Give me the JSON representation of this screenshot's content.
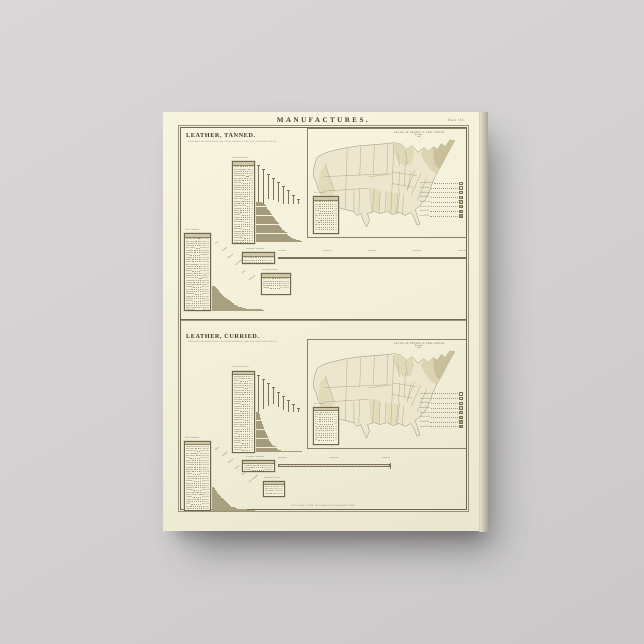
{
  "artwork": {
    "title": "MANUFACTURES.",
    "plate_number": "Plate 153.",
    "imprint": "COPYRIGHT, 1883, BY CHARLES SCRIBNER'S SONS."
  },
  "map": {
    "title": "VALUE OF PRODUCT, PER CAPITA",
    "subtitle": "By States.",
    "year": "1880.",
    "legend": [
      "Less than 10 cts.",
      "10 to 20 cts.",
      "20 to 40 cts.",
      "40 to 60 cts.",
      "60 to 80 cts.",
      "80 cts. to $1.",
      "$1 to $1.50",
      "Over $1.50"
    ],
    "legend_colors": [
      "#f1edd8",
      "#e9e4c8",
      "#ded7b6",
      "#d2caa4",
      "#c5bc92",
      "#b7ad80",
      "#a89e70",
      "#968c5e"
    ]
  },
  "sections": [
    {
      "id": "tanned",
      "heading": "LEATHER, TANNED.",
      "subheading": "SHOWING FOR EACH STATE THE TOTAL PRODUCT, AND THE VALUE PER CAPITA.",
      "per_capita": {
        "title": "Value per Capita.",
        "rows": [
          [
            "Maine",
            "$2.41"
          ],
          [
            "New Hampshire",
            "$2.10"
          ],
          [
            "Wisconsin",
            "$1.64"
          ],
          [
            "Pennsylvania",
            "$1.38"
          ],
          [
            "Massachusetts",
            "$1.21"
          ],
          [
            "New Jersey",
            "$1.05"
          ],
          [
            "Maryland",
            ".92"
          ],
          [
            "New York",
            ".88"
          ],
          [
            "Michigan",
            ".84"
          ],
          [
            "Vermont",
            ".71"
          ],
          [
            "Delaware",
            ".63"
          ],
          [
            "Virginia",
            ".54"
          ],
          [
            "California",
            ".52"
          ],
          [
            "Connecticut",
            ".47"
          ],
          [
            "West Virginia",
            ".44"
          ],
          [
            "Kentucky",
            ".41"
          ],
          [
            "Ohio",
            ".38"
          ],
          [
            "North Carolina",
            ".33"
          ],
          [
            "Tennessee",
            ".29"
          ],
          [
            "Illinois",
            ".27"
          ],
          [
            "Indiana",
            ".25"
          ],
          [
            "Missouri",
            ".22"
          ],
          [
            "Georgia",
            ".19"
          ],
          [
            "Oregon",
            ".17"
          ],
          [
            "New Mexico",
            ".15"
          ],
          [
            "Texas",
            ".12"
          ],
          [
            "Iowa",
            ".11"
          ],
          [
            "Minnesota",
            ".10"
          ],
          [
            "Alabama",
            ".08"
          ],
          [
            "Arkansas",
            ".07"
          ],
          [
            "South Carolina",
            ".06"
          ],
          [
            "Mississippi",
            ".05"
          ],
          [
            "Louisiana",
            ".04"
          ],
          [
            "Kansas",
            ".03"
          ],
          [
            "Nebraska",
            ".02"
          ],
          [
            "Florida",
            ".01"
          ]
        ]
      },
      "total_products": {
        "title": "Total Products.",
        "rows": [
          [
            "Pennsylvania",
            "$24,173,402"
          ],
          [
            "New York",
            "$22,261,522"
          ],
          [
            "Massachusetts",
            "$10,354,704"
          ],
          [
            "Wisconsin",
            "$7,967,733"
          ],
          [
            "New Jersey",
            "$5,903,292"
          ],
          [
            "Michigan",
            "$5,120,611"
          ],
          [
            "Maryland",
            "$3,986,240"
          ],
          [
            "Ohio",
            "$3,643,815"
          ],
          [
            "Virginia",
            "$2,791,406"
          ],
          [
            "Illinois",
            "$2,514,572"
          ],
          [
            "Maine",
            "$2,382,461"
          ],
          [
            "New Hampshire",
            "$2,150,224"
          ],
          [
            "California",
            "$1,983,570"
          ],
          [
            "Kentucky",
            "$1,701,333"
          ],
          [
            "Indiana",
            "$1,504,216"
          ],
          [
            "Missouri",
            "$1,218,004"
          ],
          [
            "Tennessee",
            "$1,004,152"
          ],
          [
            "North Carolina",
            "$892,317"
          ],
          [
            "Connecticut",
            "$801,454"
          ],
          [
            "Georgia",
            "$611,208"
          ],
          [
            "West Virginia",
            "$540,163"
          ],
          [
            "Vermont",
            "$471,052"
          ],
          [
            "Texas",
            "$392,618"
          ],
          [
            "Iowa",
            "$343,207"
          ],
          [
            "Minnesota",
            "$301,116"
          ],
          [
            "Oregon",
            "$252,483"
          ],
          [
            "Alabama",
            "$203,371"
          ],
          [
            "Delaware",
            "$181,226"
          ],
          [
            "Kansas",
            "$142,165"
          ],
          [
            "Arkansas",
            "$110,304"
          ],
          [
            "South Carolina",
            "$84,213"
          ],
          [
            "Mississippi",
            "$61,182"
          ],
          [
            "Louisiana",
            "$43,075"
          ],
          [
            "Nebraska",
            "$31,040"
          ],
          [
            "Rhode Island",
            "$22,516"
          ],
          [
            "Florida",
            "$11,203"
          ]
        ]
      },
      "scale_bar": {
        "title": "Principal Products.",
        "rows": [
          [
            "Sole Leather",
            "$52,240,301"
          ],
          [
            "Upper Leather",
            "$31,173,212"
          ],
          [
            "All Other",
            "$20,986,507"
          ]
        ],
        "ticks": [
          "10,000,000",
          "20,000,000",
          "30,000,000",
          "40,000,000",
          "50,000,000"
        ]
      },
      "sub_box": {
        "title": "Principal Cities.",
        "rows": [
          [
            "New York",
            "$8,214,311"
          ],
          [
            "Philadelphia",
            "$6,102,208"
          ],
          [
            "Boston",
            "$4,311,170"
          ],
          [
            "Baltimore",
            "$2,208,314"
          ],
          [
            "Chicago",
            "$1,754,220"
          ]
        ]
      },
      "corner_table": {
        "title": "Per Capita.",
        "rows": [
          [
            "Me.",
            "2.41"
          ],
          [
            "N.H.",
            "2.10"
          ],
          [
            "Wis.",
            "1.64"
          ],
          [
            "Pa.",
            "1.38"
          ],
          [
            "Mass.",
            "1.21"
          ],
          [
            "N.J.",
            "1.05"
          ],
          [
            "Md.",
            ".92"
          ],
          [
            "N.Y.",
            ".88"
          ],
          [
            "Mich.",
            ".84"
          ],
          [
            "Vt.",
            ".71"
          ],
          [
            "Del.",
            ".63"
          ],
          [
            "Va.",
            ".54"
          ],
          [
            "Cal.",
            ".52"
          ]
        ]
      }
    },
    {
      "id": "curried",
      "heading": "LEATHER, CURRIED.",
      "subheading": "SHOWING FOR EACH STATE THE TOTAL PRODUCT, AND THE VALUE PER CAPITA.",
      "per_capita": {
        "title": "Value per Capita.",
        "rows": [
          [
            "Massachusetts",
            "$15.72"
          ],
          [
            "New Hampshire",
            "$3.10"
          ],
          [
            "Maine",
            "$2.24"
          ],
          [
            "New Jersey",
            "$1.92"
          ],
          [
            "New York",
            "$1.81"
          ],
          [
            "Pennsylvania",
            "$1.12"
          ],
          [
            "Delaware",
            ".98"
          ],
          [
            "Connecticut",
            ".87"
          ],
          [
            "Maryland",
            ".76"
          ],
          [
            "Ohio",
            ".64"
          ],
          [
            "Wisconsin",
            ".58"
          ],
          [
            "Michigan",
            ".52"
          ],
          [
            "Kentucky",
            ".47"
          ],
          [
            "Virginia",
            ".41"
          ],
          [
            "California",
            ".38"
          ],
          [
            "Illinois",
            ".34"
          ],
          [
            "Missouri",
            ".28"
          ],
          [
            "Indiana",
            ".25"
          ],
          [
            "Vermont",
            ".22"
          ],
          [
            "Rhode Island",
            ".19"
          ],
          [
            "Tennessee",
            ".17"
          ],
          [
            "West Virginia",
            ".15"
          ],
          [
            "North Carolina",
            ".13"
          ],
          [
            "Georgia",
            ".11"
          ],
          [
            "Oregon",
            ".10"
          ],
          [
            "Texas",
            ".08"
          ],
          [
            "Iowa",
            ".07"
          ],
          [
            "Minnesota",
            ".06"
          ],
          [
            "Alabama",
            ".05"
          ],
          [
            "Arkansas",
            ".04"
          ],
          [
            "South Carolina",
            ".03"
          ],
          [
            "Mississippi",
            ".03"
          ],
          [
            "Louisiana",
            ".02"
          ],
          [
            "Kansas",
            ".02"
          ],
          [
            "Nebraska",
            ".01"
          ],
          [
            "Florida",
            ".01"
          ]
        ]
      },
      "total_products": {
        "title": "Total Products.",
        "rows": [
          [
            "Massachusetts",
            "$28,514,601"
          ],
          [
            "New York",
            "$17,302,415"
          ],
          [
            "Pennsylvania",
            "$9,871,360"
          ],
          [
            "New Hampshire",
            "$4,310,522"
          ],
          [
            "New Jersey",
            "$4,102,311"
          ],
          [
            "Ohio",
            "$3,213,522"
          ],
          [
            "Maine",
            "$2,401,118"
          ],
          [
            "Maryland",
            "$2,102,450"
          ],
          [
            "Wisconsin",
            "$1,812,305"
          ],
          [
            "Michigan",
            "$1,604,212"
          ],
          [
            "Kentucky",
            "$1,402,161"
          ],
          [
            "Illinois",
            "$1,311,204"
          ],
          [
            "Virginia",
            "$1,102,133"
          ],
          [
            "Connecticut",
            "$984,215"
          ],
          [
            "California",
            "$871,304"
          ],
          [
            "Missouri",
            "$740,251"
          ],
          [
            "Indiana",
            "$652,118"
          ],
          [
            "Delaware",
            "$541,203"
          ],
          [
            "Tennessee",
            "$462,170"
          ],
          [
            "Vermont",
            "$391,242"
          ],
          [
            "West Virginia",
            "$322,104"
          ],
          [
            "North Carolina",
            "$261,320"
          ],
          [
            "Georgia",
            "$221,405"
          ],
          [
            "Rhode Island",
            "$180,116"
          ],
          [
            "Oregon",
            "$141,207"
          ],
          [
            "Texas",
            "$112,304"
          ],
          [
            "Iowa",
            "$92,411"
          ],
          [
            "Minnesota",
            "$71,322"
          ],
          [
            "Alabama",
            "$52,130"
          ],
          [
            "Arkansas",
            "$41,206"
          ],
          [
            "South Carolina",
            "$31,114"
          ],
          [
            "Mississippi",
            "$22,301"
          ],
          [
            "Louisiana",
            "$15,210"
          ],
          [
            "Kansas",
            "$10,412"
          ],
          [
            "Nebraska",
            "$6,311"
          ],
          [
            "Florida",
            "$3,204"
          ]
        ]
      },
      "scale_bar": {
        "title": "Principal Products.",
        "rows": [
          [
            "Curried Leather",
            "$30,214,410"
          ],
          [
            "Finished",
            "$18,102,311"
          ],
          [
            "All Other",
            "$9,840,217"
          ]
        ],
        "ticks": [
          "10,000,000",
          "20,000,000",
          "30,000,000"
        ]
      },
      "sub_box": {
        "title": "Principal Cities.",
        "rows": [
          [
            "Boston",
            "$9,412,308"
          ],
          [
            "New York",
            "$5,211,417"
          ],
          [
            "Philadelphia",
            "$3,102,211"
          ],
          [
            "Salem",
            "$1,412,304"
          ]
        ]
      },
      "corner_table": {
        "title": "Per Capita.",
        "rows": [
          [
            "Mass.",
            "15.72"
          ],
          [
            "N.H.",
            "3.10"
          ],
          [
            "Me.",
            "2.24"
          ],
          [
            "N.J.",
            "1.92"
          ],
          [
            "N.Y.",
            "1.81"
          ],
          [
            "Pa.",
            "1.12"
          ],
          [
            "Del.",
            ".98"
          ],
          [
            "Conn.",
            ".87"
          ],
          [
            "Md.",
            ".76"
          ],
          [
            "Ohio",
            ".64"
          ],
          [
            "Wis.",
            ".58"
          ],
          [
            "Mich.",
            ".52"
          ],
          [
            "Ky.",
            ".47"
          ]
        ]
      }
    }
  ]
}
